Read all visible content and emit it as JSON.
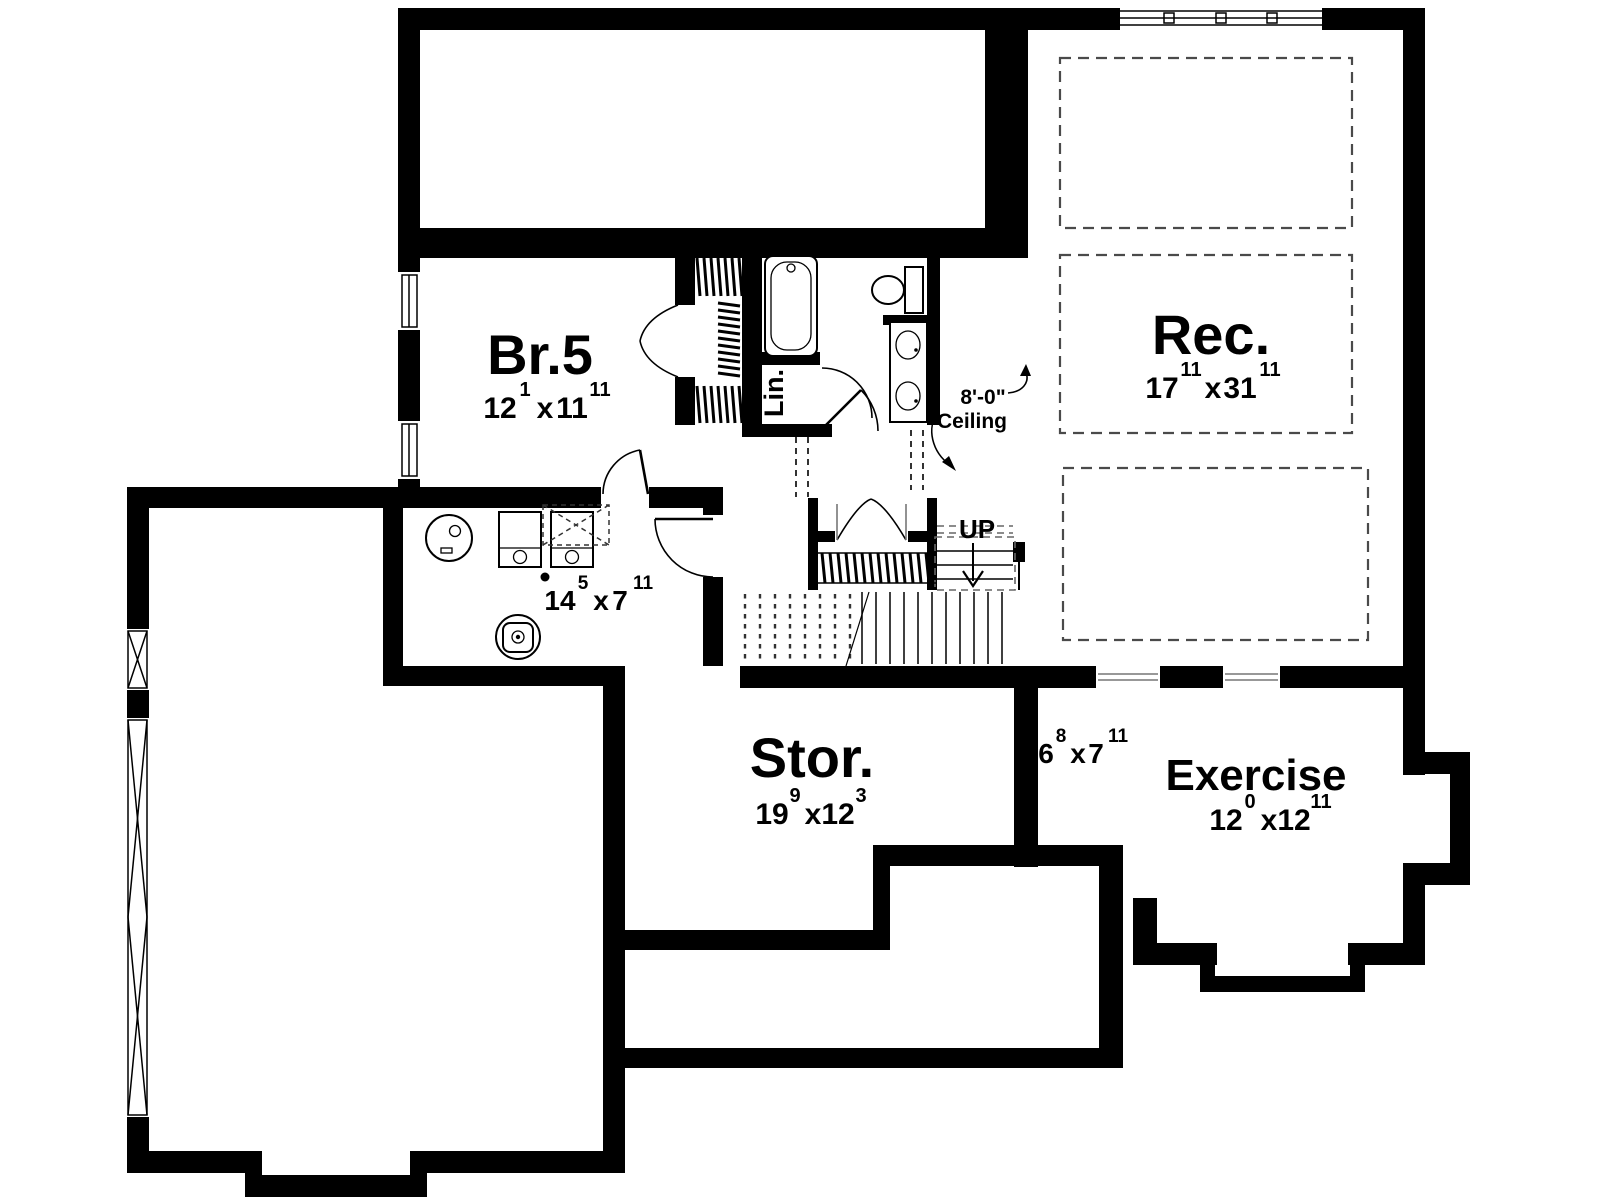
{
  "plan": {
    "title_hint": "basement floor plan",
    "rooms": {
      "br5": {
        "label": "Br.5",
        "dim": {
          "a": "12",
          "asup": "1",
          "sep": "x",
          "b": "11",
          "bsup": "11"
        }
      },
      "rec": {
        "label": "Rec.",
        "dim": {
          "a": "17",
          "asup": "11",
          "sep": "x",
          "b": "31",
          "bsup": "11"
        }
      },
      "stor": {
        "label": "Stor.",
        "dim": {
          "a": "19",
          "asup": "9",
          "sep": "x",
          "b": "12",
          "bsup": "3"
        }
      },
      "exercise": {
        "label": "Exercise",
        "dim": {
          "a": "12",
          "asup": "0",
          "sep": "x",
          "b": "12",
          "bsup": "11"
        }
      },
      "utility": {
        "dim": {
          "a": "14",
          "asup": "5",
          "sep": "x",
          "b": "7",
          "bsup": "11"
        }
      },
      "nook": {
        "dim": {
          "a": "6",
          "asup": "8",
          "sep": "x",
          "b": "7",
          "bsup": "11"
        }
      },
      "linen": {
        "label": "Lin."
      }
    },
    "annotations": {
      "stairs": "UP",
      "ceiling_height": "8'-0\"",
      "ceiling_label": "Ceiling"
    },
    "colors": {
      "wall": "#000000",
      "background": "#ffffff",
      "dashed_line": "#4a4a4a"
    }
  }
}
